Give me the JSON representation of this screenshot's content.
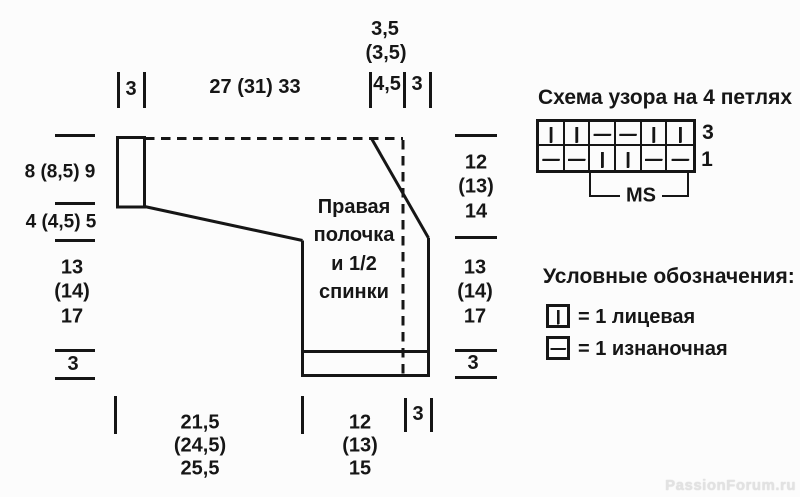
{
  "diagram": {
    "piece_label": "Правая\nполочка\nи 1/2\nспинки",
    "top": {
      "shoulder_width": "3",
      "body_width": "27 (31) 33",
      "neck_a": "3,5",
      "neck_b": "(3,5)",
      "neck_c": "4,5",
      "neck_d": "3"
    },
    "left": {
      "upper": "8 (8,5) 9",
      "slope": "4 (4,5) 5",
      "side": "13\n(14)\n17",
      "rib": "3"
    },
    "right": {
      "upper": "12\n(13)\n14",
      "lower": "13\n(14)\n17",
      "rib": "3"
    },
    "bottom": {
      "back_width": "21,5\n(24,5)\n25,5",
      "front_width": "12\n(13)\n15",
      "band": "3"
    }
  },
  "chart": {
    "title": "Схема узора на 4 петлях",
    "rows": [
      {
        "label": "3",
        "cells": [
          "|",
          "|",
          "—",
          "—",
          "|",
          "|"
        ]
      },
      {
        "label": "1",
        "cells": [
          "—",
          "—",
          "|",
          "|",
          "—",
          "—"
        ]
      }
    ],
    "repeat_label": "MS"
  },
  "legend": {
    "title": "Условные обозначения:",
    "knit_symbol": "|",
    "knit_text": "= 1 лицевая",
    "purl_symbol": "—",
    "purl_text": "= 1 изнаночная"
  },
  "watermark": "PassionForum.ru"
}
